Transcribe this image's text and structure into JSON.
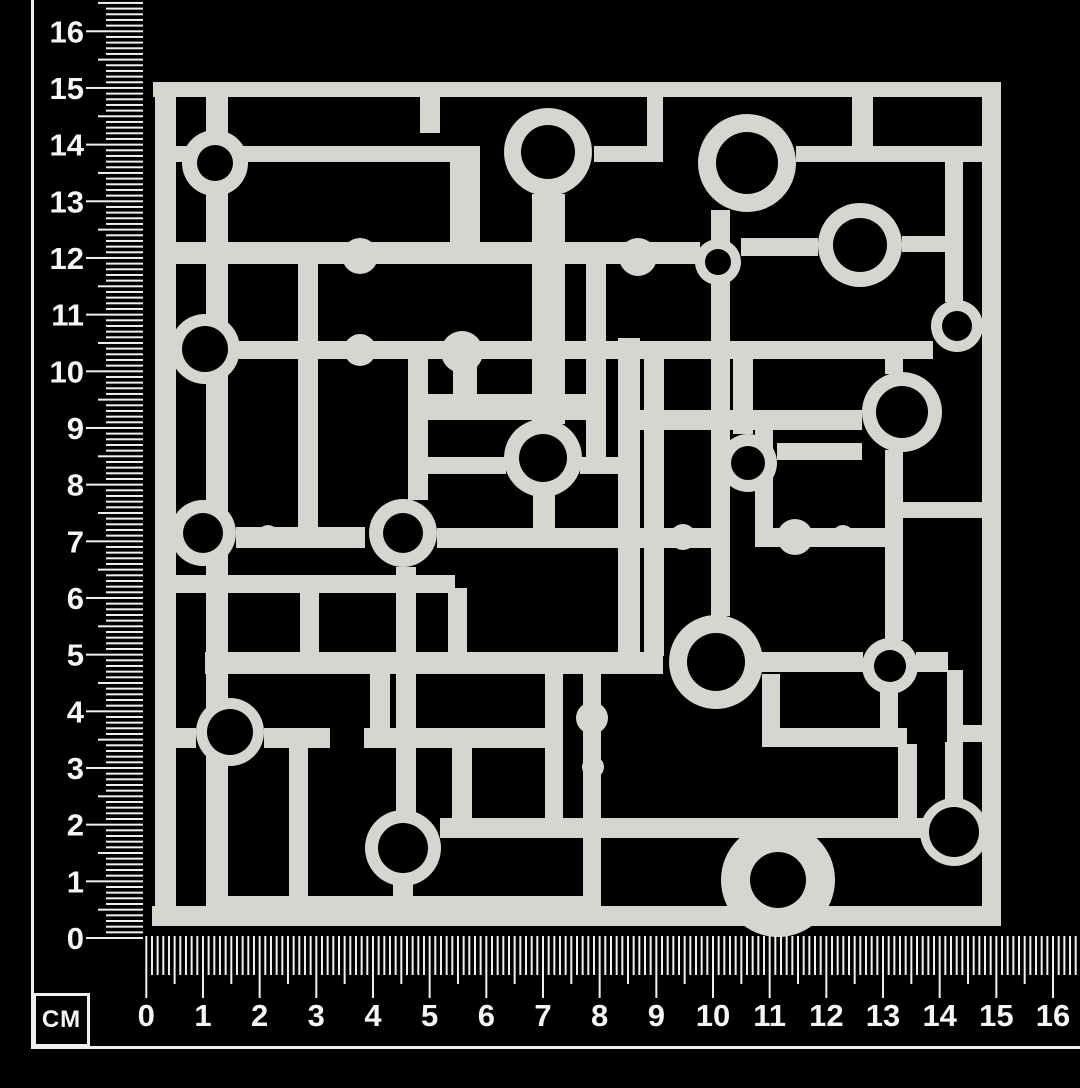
{
  "scene": {
    "background": "#000000"
  },
  "rulers": {
    "unit_label": "CM",
    "tick_color": "#f0f0ee",
    "number_color": "#f5f5f3",
    "px_per_cm": 56.67,
    "max_cm": 16.5,
    "left": {
      "labels": [
        "0",
        "1",
        "2",
        "3",
        "4",
        "5",
        "6",
        "7",
        "8",
        "9",
        "10",
        "11",
        "12",
        "13",
        "14",
        "15",
        "16"
      ],
      "origin_y": 938,
      "tick_edge_x": 143,
      "cm_len": 57,
      "half_len": 45,
      "mm_len": 37,
      "label_x": 84,
      "font_size": 31
    },
    "bottom": {
      "labels": [
        "0",
        "1",
        "2",
        "3",
        "4",
        "5",
        "6",
        "7",
        "8",
        "9",
        "10",
        "11",
        "12",
        "13",
        "14",
        "15",
        "16"
      ],
      "origin_x": 146.3,
      "tick_edge_y": 936,
      "cm_len": 62,
      "half_len": 48,
      "mm_len": 39,
      "label_y": 1026,
      "font_size": 31,
      "clip_x": 1080
    }
  },
  "design": {
    "color": "#d6d5d0",
    "hole_color": "#000000",
    "frame": [
      [
        153,
        82,
        848,
        15
      ],
      [
        152,
        906,
        849,
        20
      ],
      [
        155,
        82,
        21,
        844
      ],
      [
        982,
        82,
        19,
        844
      ]
    ],
    "bars": [
      [
        176,
        146,
        277,
        16
      ],
      [
        594,
        146,
        69,
        16
      ],
      [
        796,
        146,
        186,
        16
      ],
      [
        176,
        242,
        524,
        22
      ],
      [
        741,
        238,
        77,
        18
      ],
      [
        902,
        236,
        44,
        16
      ],
      [
        239,
        341,
        694,
        18
      ],
      [
        408,
        394,
        192,
        26
      ],
      [
        640,
        410,
        222,
        20
      ],
      [
        777,
        443,
        85,
        17
      ],
      [
        428,
        457,
        78,
        17
      ],
      [
        580,
        457,
        40,
        17
      ],
      [
        885,
        502,
        97,
        16
      ],
      [
        236,
        527,
        129,
        21
      ],
      [
        437,
        528,
        283,
        20
      ],
      [
        755,
        528,
        130,
        19
      ],
      [
        176,
        575,
        279,
        18
      ],
      [
        205,
        652,
        458,
        22
      ],
      [
        761,
        652,
        102,
        20
      ],
      [
        916,
        652,
        32,
        20
      ],
      [
        176,
        728,
        20,
        20
      ],
      [
        264,
        728,
        66,
        20
      ],
      [
        364,
        728,
        181,
        20
      ],
      [
        762,
        728,
        145,
        19
      ],
      [
        947,
        725,
        37,
        17
      ],
      [
        440,
        818,
        485,
        20
      ],
      [
        228,
        896,
        373,
        20
      ],
      [
        206,
        97,
        22,
        809
      ],
      [
        298,
        263,
        20,
        277
      ],
      [
        300,
        588,
        19,
        70
      ],
      [
        408,
        354,
        20,
        146
      ],
      [
        396,
        567,
        20,
        245
      ],
      [
        370,
        672,
        20,
        58
      ],
      [
        393,
        884,
        20,
        24
      ],
      [
        453,
        350,
        24,
        46
      ],
      [
        448,
        588,
        19,
        68
      ],
      [
        452,
        748,
        20,
        76
      ],
      [
        532,
        194,
        33,
        230
      ],
      [
        533,
        494,
        22,
        36
      ],
      [
        545,
        672,
        18,
        150
      ],
      [
        586,
        258,
        20,
        204
      ],
      [
        450,
        146,
        30,
        98
      ],
      [
        583,
        672,
        18,
        236
      ],
      [
        618,
        338,
        22,
        320
      ],
      [
        644,
        356,
        20,
        300
      ],
      [
        647,
        97,
        16,
        50
      ],
      [
        711,
        210,
        19,
        406
      ],
      [
        733,
        354,
        20,
        80
      ],
      [
        762,
        674,
        18,
        56
      ],
      [
        852,
        97,
        21,
        50
      ],
      [
        885,
        352,
        18,
        22
      ],
      [
        885,
        450,
        18,
        54
      ],
      [
        885,
        516,
        18,
        124
      ],
      [
        880,
        690,
        18,
        40
      ],
      [
        898,
        744,
        19,
        80
      ],
      [
        945,
        158,
        18,
        144
      ],
      [
        947,
        670,
        16,
        58
      ],
      [
        945,
        742,
        18,
        62
      ],
      [
        755,
        430,
        18,
        100
      ],
      [
        420,
        97,
        20,
        36
      ],
      [
        289,
        746,
        19,
        160
      ]
    ],
    "rings": [
      [
        215,
        163,
        33,
        18
      ],
      [
        548,
        152,
        44,
        27
      ],
      [
        747,
        163,
        49,
        31
      ],
      [
        860,
        245,
        42,
        27
      ],
      [
        718,
        262,
        23,
        13
      ],
      [
        957,
        326,
        26,
        15
      ],
      [
        205,
        349,
        35,
        23
      ],
      [
        902,
        412,
        40,
        26
      ],
      [
        543,
        458,
        39,
        24
      ],
      [
        748,
        463,
        29,
        17
      ],
      [
        203,
        533,
        33,
        20
      ],
      [
        403,
        533,
        34,
        20
      ],
      [
        716,
        662,
        47,
        29
      ],
      [
        890,
        666,
        28,
        16
      ],
      [
        230,
        732,
        34,
        23
      ],
      [
        403,
        848,
        38,
        25
      ],
      [
        778,
        880,
        57,
        28
      ],
      [
        954,
        832,
        34,
        25
      ]
    ],
    "dots": [
      [
        360,
        256,
        18
      ],
      [
        638,
        257,
        19
      ],
      [
        360,
        350,
        16
      ],
      [
        462,
        352,
        21
      ],
      [
        268,
        535,
        10
      ],
      [
        683,
        537,
        13
      ],
      [
        795,
        537,
        18
      ],
      [
        843,
        536,
        11
      ],
      [
        592,
        718,
        16
      ],
      [
        593,
        767,
        11
      ]
    ]
  }
}
